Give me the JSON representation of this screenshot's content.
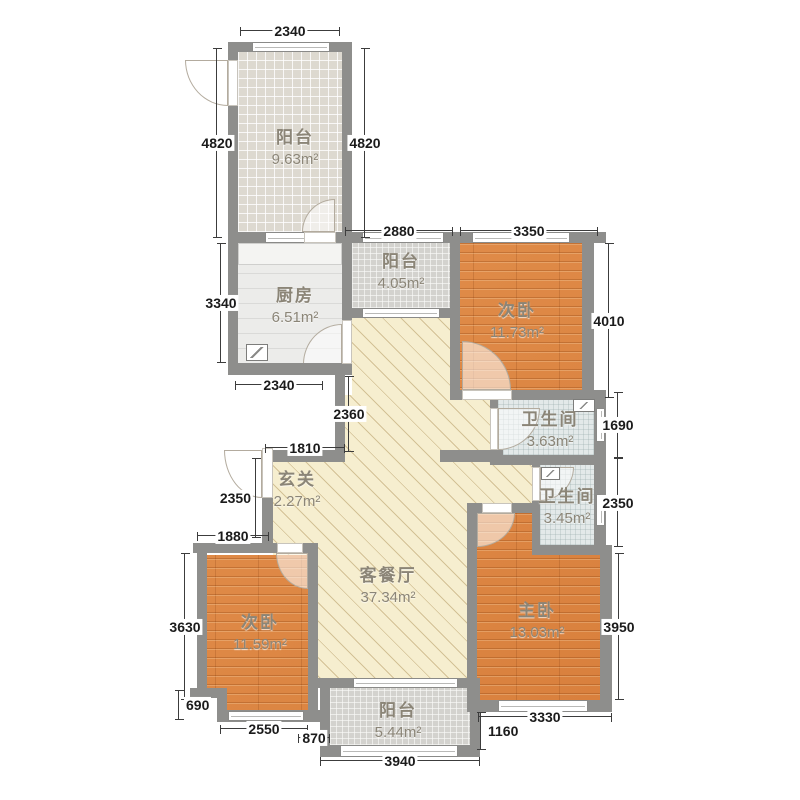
{
  "rooms": [
    {
      "name": "阳台",
      "area": "9.63m²"
    },
    {
      "name": "厨房",
      "area": "6.51m²"
    },
    {
      "name": "阳台",
      "area": "4.05m²"
    },
    {
      "name": "次卧",
      "area": "11.73m²"
    },
    {
      "name": "卫生间",
      "area": "3.63m²"
    },
    {
      "name": "卫生间",
      "area": "3.45m²"
    },
    {
      "name": "玄关",
      "area": "2.27m²"
    },
    {
      "name": "客餐厅",
      "area": "37.34m²"
    },
    {
      "name": "次卧",
      "area": "11.59m²"
    },
    {
      "name": "主卧",
      "area": "13.03m²"
    },
    {
      "name": "阳台",
      "area": "5.44m²"
    }
  ],
  "dims": {
    "balcony_tl_width": "2340",
    "balcony_tl_left": "4820",
    "balcony_tl_right": "4820",
    "balcony_mid_width": "2880",
    "bedroom_tr_width": "3350",
    "kitchen_height": "3340",
    "bedroom_tr_height": "4010",
    "kitchen_width": "2340",
    "hall_height": "2360",
    "hall_width": "1810",
    "bath1_height": "1690",
    "bath2_height": "2350",
    "entry_height": "2350",
    "bedroom_l_top": "1880",
    "bedroom_l_height": "3630",
    "notch_height": "690",
    "bedroom_l_width": "2550",
    "gap_small": "870",
    "balcony_b_width": "3940",
    "gap_right": "1160",
    "master_width": "3330",
    "master_height": "3950"
  },
  "colors": {
    "wall": "#8e8e8c",
    "wood_floor": "#df8440",
    "living_floor": "#f6eecf",
    "kitchen_floor": "#ececea",
    "balcony_tile": "#d3d2ce",
    "bath_tile": "#e3e9e9",
    "dimension_text": "#1b1b1b",
    "room_label_text": "#8b8577"
  }
}
